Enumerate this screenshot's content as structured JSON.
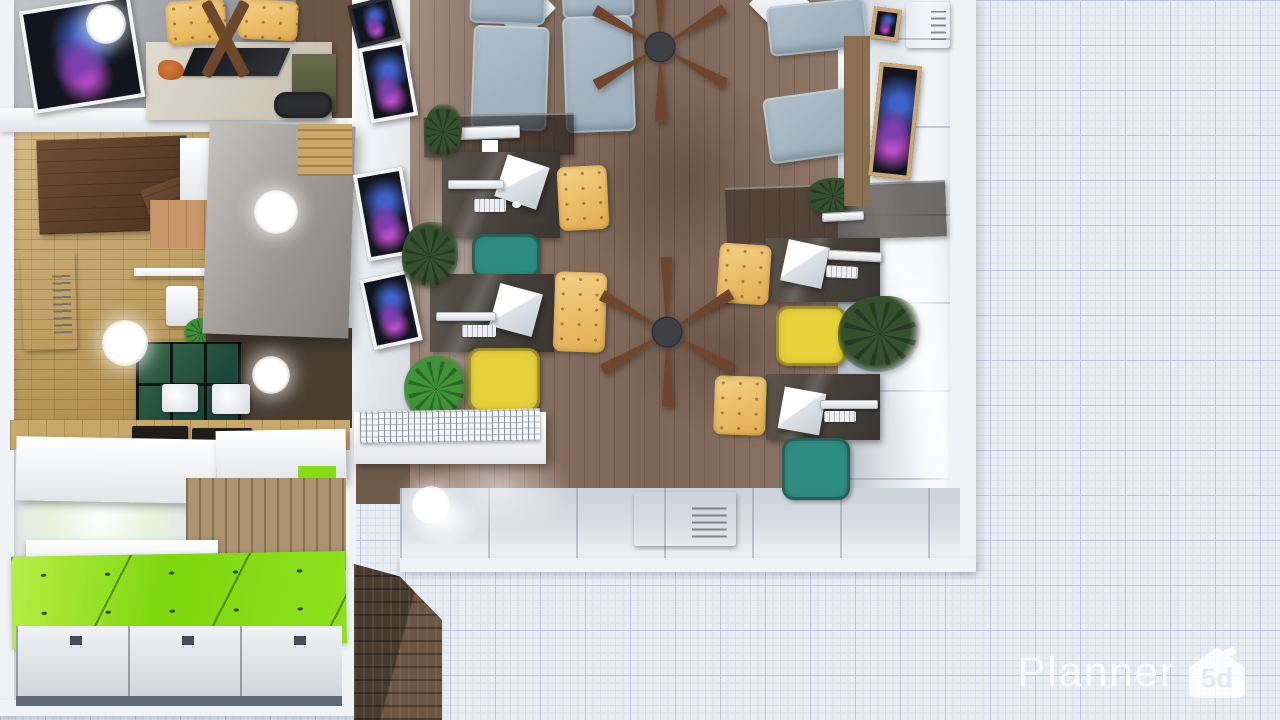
{
  "watermark": {
    "brand": "Planner",
    "badge": "5d"
  },
  "palette": {
    "gridBg": "#e9edf4",
    "gridMajor": "#bdc6d8",
    "gridMinor": "#d9dfe9",
    "wallWhite": "#f0f3f6",
    "woodFloor": "#8a7161",
    "parquet": "#c9a55e",
    "lockersGreen": "#84dc14",
    "lockerFront": "#dfe2e7",
    "brick": "#473a2f",
    "brickSide": "#6d5645",
    "armchair": "#9fb1bd",
    "deskDark": "#4e463f",
    "chairWood": "#e0ae53",
    "chairYellow": "#e7d23a",
    "chairTeal": "#2f8e83",
    "plantDark": "#35502f",
    "plantBright": "#3f9338",
    "fanBlade": "#6f462c",
    "fanHub": "#3c4044",
    "cabinetBrown": "#5d4230",
    "cabinetOlive": "#686c4c",
    "counterWood": "#c9a86b",
    "woodWall": "#ab9270",
    "nebulaA": "#7b3fae",
    "nebulaB": "#3f62c8",
    "nebulaC": "#c24fd0",
    "logoWhite": "rgba(255,255,255,0.82)",
    "logoCutout": "#e4e8f1"
  },
  "scene": {
    "items": [
      {
        "n": "wood-floor-strip",
        "t": "counter",
        "x": 296,
        "y": 0,
        "w": 56,
        "h": 118,
        "c": "#6b5645",
        "i": false
      },
      {
        "n": "meeting-desk",
        "t": "desk-beige",
        "x": 146,
        "y": 42,
        "w": 186,
        "h": 78,
        "i": true
      },
      {
        "n": "desk-glass-inset",
        "t": "glass-inset",
        "x": 188,
        "y": 48,
        "w": 96,
        "h": 28,
        "i": false
      },
      {
        "n": "fox-figurine",
        "t": "figurine",
        "x": 158,
        "y": 60,
        "w": 26,
        "h": 20,
        "i": true
      },
      {
        "n": "wood-chair",
        "t": "wood-chair",
        "x": 166,
        "y": 0,
        "w": 60,
        "h": 44,
        "r": -4,
        "c": "#d9b97e",
        "i": true
      },
      {
        "n": "wood-chair",
        "t": "wood-chair",
        "x": 238,
        "y": 0,
        "w": 60,
        "h": 40,
        "r": 3,
        "c": "#d9b97e",
        "i": true
      },
      {
        "n": "table-cross-legs",
        "t": "xlegs",
        "x": 176,
        "y": 0,
        "w": 96,
        "h": 78,
        "i": true
      },
      {
        "n": "olive-cabinet",
        "t": "cabinet-olive",
        "x": 292,
        "y": 54,
        "w": 44,
        "h": 58,
        "i": true
      },
      {
        "n": "desk-chair",
        "t": "office-chair",
        "x": 274,
        "y": 92,
        "w": 58,
        "h": 26,
        "c": "#2c2e31",
        "i": true
      },
      {
        "n": "wall-picture",
        "t": "picture",
        "x": 26,
        "y": 2,
        "w": 112,
        "h": 104,
        "r": -9,
        "i": true
      },
      {
        "n": "kitchen-cabinet",
        "t": "cabinet-brown",
        "x": 38,
        "y": 138,
        "w": 150,
        "h": 94,
        "r": -2,
        "i": true
      },
      {
        "n": "cabinet-door-open",
        "t": "cabinet-brown",
        "x": 148,
        "y": 178,
        "w": 64,
        "h": 56,
        "r": -20,
        "c": "#7a5338",
        "i": true
      },
      {
        "n": "counter-white",
        "t": "bench",
        "x": 180,
        "y": 138,
        "w": 34,
        "h": 66,
        "i": false
      },
      {
        "n": "kitchen-board",
        "t": "counter",
        "x": 150,
        "y": 200,
        "w": 58,
        "h": 48,
        "c": "#c8976a",
        "i": false
      },
      {
        "n": "ac-unit",
        "t": "ac",
        "x": 22,
        "y": 252,
        "w": 54,
        "h": 98,
        "r": -2,
        "i": true
      },
      {
        "n": "glass-shelf",
        "t": "shelf",
        "x": 134,
        "y": 268,
        "w": 78,
        "h": 8,
        "i": false
      },
      {
        "n": "pitcher",
        "t": "pitcher",
        "x": 166,
        "y": 286,
        "w": 32,
        "h": 40,
        "i": true
      },
      {
        "n": "small-plant",
        "t": "plant",
        "x": 184,
        "y": 318,
        "w": 34,
        "h": 30,
        "c": "#3f9338",
        "i": true
      },
      {
        "n": "dark-floor-patch",
        "t": "patch",
        "x": 206,
        "y": 328,
        "w": 146,
        "h": 100,
        "c": "#4a3e33",
        "i": false
      },
      {
        "n": "glass-cabinet",
        "t": "cabinet-green",
        "x": 136,
        "y": 342,
        "w": 106,
        "h": 86,
        "i": true
      },
      {
        "n": "mug",
        "t": "cup",
        "x": 162,
        "y": 384,
        "w": 36,
        "h": 28,
        "i": true
      },
      {
        "n": "mug",
        "t": "cup",
        "x": 212,
        "y": 384,
        "w": 38,
        "h": 30,
        "i": true
      },
      {
        "n": "counter-band",
        "t": "counter",
        "x": 10,
        "y": 420,
        "w": 340,
        "h": 30,
        "i": false
      },
      {
        "n": "serving-tray",
        "t": "tray",
        "x": 132,
        "y": 426,
        "w": 56,
        "h": 16,
        "i": true
      },
      {
        "n": "serving-tray",
        "t": "tray",
        "x": 192,
        "y": 428,
        "w": 60,
        "h": 18,
        "i": true
      },
      {
        "n": "partition-wall",
        "t": "partition",
        "x": 206,
        "y": 124,
        "w": 146,
        "h": 212,
        "r": 2,
        "i": false
      },
      {
        "n": "wood-beam",
        "t": "beam",
        "x": 298,
        "y": 124,
        "w": 54,
        "h": 52,
        "i": false
      },
      {
        "n": "light-glow",
        "t": "glow",
        "x": 6,
        "y": 444,
        "w": 190,
        "h": 152,
        "i": false
      },
      {
        "n": "upper-cabinet",
        "t": "bench",
        "x": 16,
        "y": 438,
        "w": 200,
        "h": 64,
        "r": 1,
        "i": true
      },
      {
        "n": "upper-cabinet",
        "t": "bench",
        "x": 216,
        "y": 430,
        "w": 130,
        "h": 52,
        "r": -1,
        "i": true
      },
      {
        "n": "green-counter-sliver",
        "t": "patch",
        "x": 298,
        "y": 466,
        "w": 38,
        "h": 14,
        "c": "#84dc14",
        "i": false
      },
      {
        "n": "wood-panel-wall",
        "t": "wall-wood",
        "x": 186,
        "y": 478,
        "w": 160,
        "h": 92,
        "i": false
      },
      {
        "n": "wall-shelf",
        "t": "shelf",
        "x": 26,
        "y": 540,
        "w": 192,
        "h": 26,
        "i": true
      },
      {
        "n": "lockers-top",
        "t": "lockers-top",
        "x": 12,
        "y": 554,
        "w": 334,
        "h": 92,
        "r": -1,
        "i": true
      },
      {
        "n": "locker-fronts",
        "t": "locker-fronts",
        "x": 16,
        "y": 626,
        "w": 326,
        "h": 80,
        "i": true
      },
      {
        "n": "floor-shadow",
        "t": "shadow",
        "x": 520,
        "y": 30,
        "w": 330,
        "h": 300,
        "i": false
      },
      {
        "n": "floor-shadow",
        "t": "shadow",
        "x": 580,
        "y": 230,
        "w": 300,
        "h": 240,
        "i": false
      },
      {
        "n": "light-pool",
        "t": "poolw",
        "x": 404,
        "y": 120,
        "w": 90,
        "h": 330,
        "i": false
      },
      {
        "n": "light-pool",
        "t": "poolw",
        "x": 398,
        "y": 430,
        "w": 200,
        "h": 120,
        "i": false
      },
      {
        "n": "wall-picture",
        "t": "picture",
        "x": 352,
        "y": 0,
        "w": 44,
        "h": 44,
        "r": -14,
        "c": "#2a2d36",
        "i": true
      },
      {
        "n": "wall-picture",
        "t": "picture",
        "x": 364,
        "y": 44,
        "w": 48,
        "h": 76,
        "r": -10,
        "i": true
      },
      {
        "n": "wall-picture",
        "t": "picture",
        "x": 360,
        "y": 170,
        "w": 50,
        "h": 88,
        "r": -10,
        "i": true
      },
      {
        "n": "wall-picture",
        "t": "picture",
        "x": 366,
        "y": 274,
        "w": 50,
        "h": 72,
        "r": -12,
        "i": true
      },
      {
        "n": "side-table",
        "t": "diamond",
        "x": 498,
        "y": -16,
        "w": 48,
        "h": 48,
        "r": 45,
        "i": true
      },
      {
        "n": "side-table",
        "t": "diamond",
        "x": 758,
        "y": -18,
        "w": 44,
        "h": 44,
        "r": 45,
        "i": true
      },
      {
        "n": "lounge-armchair",
        "t": "armchair",
        "x": 470,
        "y": -34,
        "w": 76,
        "h": 58,
        "r": 2,
        "i": true
      },
      {
        "n": "lounge-armchair",
        "t": "armchair",
        "x": 562,
        "y": -30,
        "w": 72,
        "h": 48,
        "r": -2,
        "i": true
      },
      {
        "n": "lounge-armchair",
        "t": "armchair",
        "x": 472,
        "y": 26,
        "w": 76,
        "h": 104,
        "r": 2,
        "i": true
      },
      {
        "n": "lounge-armchair",
        "t": "armchair",
        "x": 564,
        "y": 16,
        "w": 70,
        "h": 116,
        "r": -2,
        "i": true
      },
      {
        "n": "lounge-armchair",
        "t": "armchair",
        "x": 768,
        "y": 2,
        "w": 98,
        "h": 50,
        "r": -6,
        "i": true
      },
      {
        "n": "lounge-armchair",
        "t": "armchair",
        "x": 766,
        "y": 92,
        "w": 100,
        "h": 66,
        "r": -8,
        "i": true
      },
      {
        "n": "glass-desk",
        "t": "glass-desk",
        "x": 424,
        "y": 114,
        "w": 150,
        "h": 42,
        "r": -1,
        "i": true
      },
      {
        "n": "monitor",
        "t": "monitor",
        "x": 458,
        "y": 126,
        "w": 62,
        "h": 13,
        "r": -2,
        "i": true
      },
      {
        "n": "monitor-stand",
        "t": "paper",
        "x": 482,
        "y": 140,
        "w": 16,
        "h": 20,
        "i": false
      },
      {
        "n": "desk",
        "t": "desk",
        "x": 442,
        "y": 152,
        "w": 118,
        "h": 86,
        "i": true
      },
      {
        "n": "pc-tower",
        "t": "pc",
        "x": 500,
        "y": 160,
        "w": 44,
        "h": 44,
        "r": 18,
        "i": true
      },
      {
        "n": "monitor",
        "t": "monitor",
        "x": 448,
        "y": 180,
        "w": 56,
        "h": 9,
        "i": true
      },
      {
        "n": "keyboard",
        "t": "keyboard",
        "x": 474,
        "y": 199,
        "w": 32,
        "h": 13,
        "i": true
      },
      {
        "n": "mouse",
        "t": "mouse",
        "x": 512,
        "y": 201,
        "w": 9,
        "h": 7,
        "i": true
      },
      {
        "n": "wood-chair",
        "t": "wood-chair",
        "x": 558,
        "y": 166,
        "w": 50,
        "h": 64,
        "r": -3,
        "i": true
      },
      {
        "n": "office-chair",
        "t": "office-chair",
        "x": 472,
        "y": 234,
        "w": 68,
        "h": 44,
        "c": "#2f8e83",
        "i": true
      },
      {
        "n": "desk",
        "t": "desk",
        "x": 430,
        "y": 274,
        "w": 124,
        "h": 78,
        "i": true
      },
      {
        "n": "pc-tower",
        "t": "pc",
        "x": 494,
        "y": 288,
        "w": 44,
        "h": 44,
        "r": 15,
        "i": true
      },
      {
        "n": "monitor",
        "t": "monitor",
        "x": 436,
        "y": 312,
        "w": 60,
        "h": 9,
        "i": true
      },
      {
        "n": "keyboard",
        "t": "keyboard",
        "x": 462,
        "y": 325,
        "w": 34,
        "h": 12,
        "i": true
      },
      {
        "n": "wood-chair",
        "t": "wood-chair",
        "x": 554,
        "y": 272,
        "w": 52,
        "h": 80,
        "r": 2,
        "i": true
      },
      {
        "n": "office-chair",
        "t": "office-chair",
        "x": 468,
        "y": 348,
        "w": 72,
        "h": 64,
        "c": "#e7d23a",
        "i": true
      },
      {
        "n": "potted-plant",
        "t": "plant",
        "x": 402,
        "y": 222,
        "w": 56,
        "h": 70,
        "i": true
      },
      {
        "n": "potted-plant",
        "t": "plant",
        "x": 404,
        "y": 356,
        "w": 64,
        "h": 66,
        "c": "#3f9338",
        "i": true
      },
      {
        "n": "potted-plant",
        "t": "plant",
        "x": 424,
        "y": 104,
        "w": 38,
        "h": 56,
        "i": true
      },
      {
        "n": "bench",
        "t": "bench",
        "x": 354,
        "y": 412,
        "w": 192,
        "h": 52,
        "i": true
      },
      {
        "n": "bench-grate",
        "t": "grate",
        "x": 360,
        "y": 410,
        "w": 180,
        "h": 32,
        "r": -1,
        "i": false
      },
      {
        "n": "glass-desk",
        "t": "glass-desk",
        "x": 726,
        "y": 184,
        "w": 220,
        "h": 56,
        "r": -2,
        "i": true
      },
      {
        "n": "desk-plant",
        "t": "plant",
        "x": 806,
        "y": 178,
        "w": 54,
        "h": 36,
        "i": true
      },
      {
        "n": "monitor",
        "t": "monitor",
        "x": 822,
        "y": 212,
        "w": 42,
        "h": 9,
        "r": -3,
        "i": true
      },
      {
        "n": "desk",
        "t": "desk",
        "x": 766,
        "y": 238,
        "w": 114,
        "h": 64,
        "i": true
      },
      {
        "n": "pc-tower",
        "t": "pc",
        "x": 784,
        "y": 243,
        "w": 42,
        "h": 42,
        "r": 12,
        "i": true
      },
      {
        "n": "monitor",
        "t": "monitor",
        "x": 828,
        "y": 251,
        "w": 54,
        "h": 10,
        "r": 3,
        "i": true
      },
      {
        "n": "keyboard",
        "t": "keyboard",
        "x": 826,
        "y": 266,
        "w": 32,
        "h": 12,
        "r": 3,
        "i": true
      },
      {
        "n": "wood-chair",
        "t": "wood-chair",
        "x": 718,
        "y": 244,
        "w": 52,
        "h": 60,
        "r": 4,
        "i": true
      },
      {
        "n": "office-chair",
        "t": "office-chair",
        "x": 776,
        "y": 306,
        "w": 70,
        "h": 60,
        "c": "#e7d23a",
        "i": true
      },
      {
        "n": "palm-plant",
        "t": "plant",
        "x": 838,
        "y": 296,
        "w": 84,
        "h": 76,
        "i": true
      },
      {
        "n": "desk",
        "t": "desk",
        "x": 766,
        "y": 374,
        "w": 114,
        "h": 66,
        "i": true
      },
      {
        "n": "pc-tower",
        "t": "pc",
        "x": 781,
        "y": 390,
        "w": 42,
        "h": 42,
        "r": 10,
        "i": true
      },
      {
        "n": "monitor",
        "t": "monitor",
        "x": 820,
        "y": 400,
        "w": 58,
        "h": 9,
        "i": true
      },
      {
        "n": "keyboard",
        "t": "keyboard",
        "x": 824,
        "y": 411,
        "w": 32,
        "h": 11,
        "i": true
      },
      {
        "n": "wood-chair",
        "t": "wood-chair",
        "x": 714,
        "y": 376,
        "w": 52,
        "h": 59,
        "r": 2,
        "i": true
      },
      {
        "n": "office-chair",
        "t": "office-chair",
        "x": 782,
        "y": 438,
        "w": 68,
        "h": 62,
        "c": "#2f8e83",
        "z": 21,
        "i": true
      },
      {
        "n": "wood-slats",
        "t": "counter",
        "x": 844,
        "y": 36,
        "w": 26,
        "h": 170,
        "c": "#8a6f52",
        "i": false
      },
      {
        "n": "wall-picture",
        "t": "picture",
        "x": 874,
        "y": 64,
        "w": 42,
        "h": 114,
        "r": 6,
        "c": "#c9a873",
        "i": true
      },
      {
        "n": "wall-picture",
        "t": "picture",
        "x": 872,
        "y": 8,
        "w": 28,
        "h": 32,
        "r": 8,
        "c": "#c9a873",
        "i": true
      },
      {
        "n": "ac-unit",
        "t": "ac",
        "x": 906,
        "y": 2,
        "w": 44,
        "h": 46,
        "i": true
      },
      {
        "n": "ac-floor-unit",
        "t": "ac",
        "x": 634,
        "y": 492,
        "w": 102,
        "h": 54,
        "z": 21,
        "i": true
      },
      {
        "n": "ceiling-fan",
        "t": "fan",
        "x": 585,
        "y": -28,
        "w": 150,
        "h": 150,
        "z": 30,
        "i": true
      },
      {
        "n": "ceiling-fan",
        "t": "fan",
        "x": 592,
        "y": 257,
        "w": 150,
        "h": 150,
        "z": 30,
        "i": true
      },
      {
        "n": "ceiling-light",
        "t": "light",
        "x": 86,
        "y": 4,
        "w": 40,
        "h": 40,
        "z": 31,
        "i": false
      },
      {
        "n": "ceiling-light",
        "t": "light",
        "x": 254,
        "y": 190,
        "w": 44,
        "h": 44,
        "z": 31,
        "i": false
      },
      {
        "n": "ceiling-light",
        "t": "light",
        "x": 102,
        "y": 320,
        "w": 46,
        "h": 46,
        "z": 31,
        "i": false
      },
      {
        "n": "ceiling-light",
        "t": "light",
        "x": 252,
        "y": 356,
        "w": 38,
        "h": 38,
        "z": 31,
        "i": false
      },
      {
        "n": "ceiling-light",
        "t": "light",
        "x": 412,
        "y": 486,
        "w": 38,
        "h": 38,
        "z": 31,
        "i": false
      }
    ]
  }
}
